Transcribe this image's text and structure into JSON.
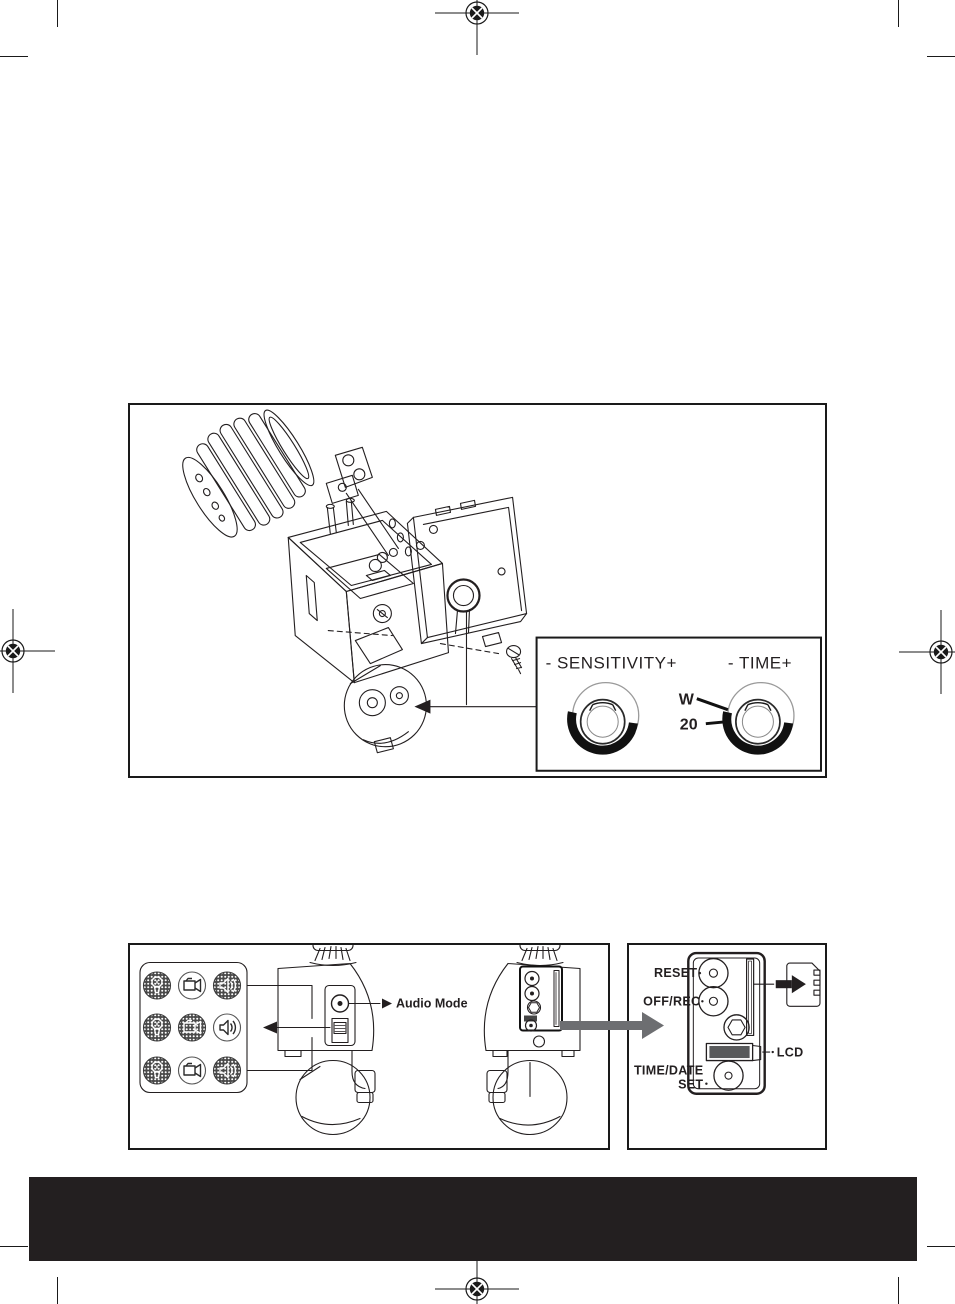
{
  "colors": {
    "ink": "#231f20",
    "footer_bar": "#231f20",
    "zoom_arrow_gray": "#6d6e71",
    "lcd_fill": "#58595b"
  },
  "figure1": {
    "inset": {
      "sensitivity_label": "- SENSITIVITY+",
      "time_label": "- TIME+",
      "w_tick": "W",
      "twenty_tick": "20"
    }
  },
  "figure2": {
    "audio_mode_label": "Audio Mode",
    "mode_grid": {
      "columns": [
        "light-icon",
        "camera-icon",
        "speaker-icon"
      ],
      "rows": [
        {
          "light": "disabled",
          "camera": "enabled",
          "speaker": "disabled"
        },
        {
          "light": "disabled",
          "camera": "disabled",
          "speaker": "enabled"
        },
        {
          "light": "disabled",
          "camera": "enabled",
          "speaker": "disabled"
        }
      ]
    }
  },
  "figure3": {
    "reset_label": "RESET",
    "off_rec_label": "OFF/REC",
    "lcd_label": "LCD",
    "time_date_line1": "TIME/DATE",
    "time_date_line2": "SET",
    "memory_card_icon": "sd-card-icon"
  }
}
